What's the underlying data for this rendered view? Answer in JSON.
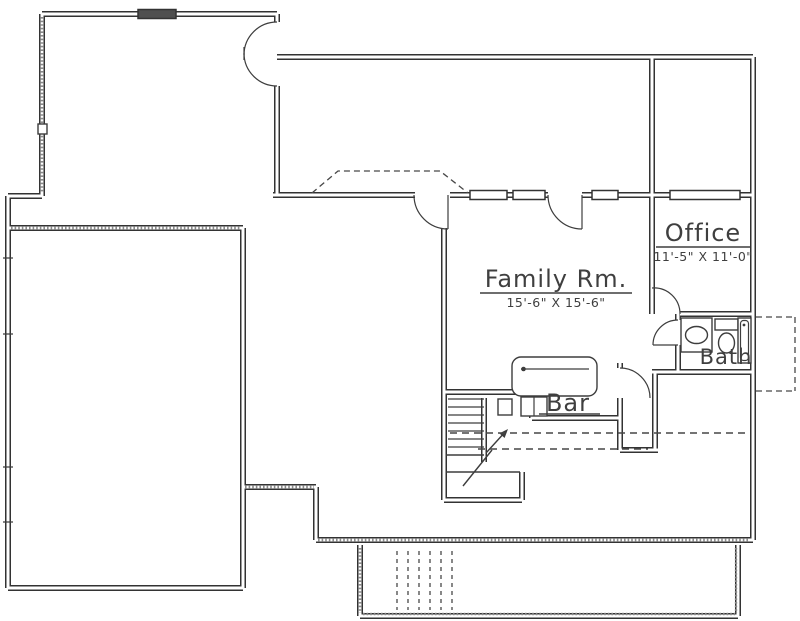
{
  "floor_plan": {
    "labels": {
      "family_room": {
        "name": "Family Rm.",
        "dims": "15'-6\" X 15'-6\""
      },
      "office": {
        "name": "Office",
        "dims": "11'-5\" X 11'-0\""
      },
      "bath": {
        "name": "Bath"
      },
      "bar": {
        "name": "Bar"
      }
    },
    "colors": {
      "wall_line": "#333333",
      "thin_line": "#3d3d3d",
      "background": "#ffffff",
      "window_fill": "#4f4f4f"
    }
  }
}
